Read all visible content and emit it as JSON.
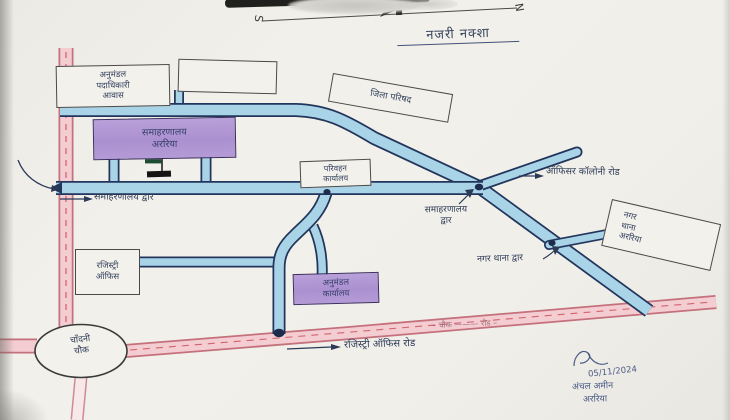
{
  "page": {
    "title": "नजरी नक्शा"
  },
  "compass": {
    "south": "S",
    "north": "N"
  },
  "places": {
    "sdo_residence": "अनुमंडल\nपदाधिकारी\nआवास",
    "zila_parishad": "जिला परिषद",
    "collectorate": "समाहरणालय\nअररिया",
    "transport_office": "परिवहन\nकार्यालय",
    "registry_office": "रजिस्ट्री\nऑफिस",
    "subdivision_office": "अनुमंडल\nकार्यालय",
    "nagar_thana": "नगर\nथाना\nअररिया",
    "chandni_chowk": "चाँदनी\nचौक"
  },
  "labels": {
    "collectorate_gate_west": "समाहरणालय द्वार",
    "collectorate_gate_south": "समाहरणालय\nद्वार",
    "officer_colony_road": "ऑफिसर कॉलोनी रोड",
    "nagar_thana_gate": "नगर थाना द्वार",
    "registry_office_road": "रजिस्ट्री ऑफिस रोड",
    "road_inscription": "– चौक ——— रोड –"
  },
  "signature": {
    "date": "05/11/2024",
    "name": "अंचल अमीन",
    "place": "अररिया"
  },
  "colors": {
    "road_blue_fill": "#a9d3e6",
    "road_blue_edge": "#22355c",
    "road_pink_fill": "#f3cdd2",
    "road_pink_edge": "#c4717c",
    "dash_red": "#c94a52",
    "highlight_purple": "#b096d4",
    "ink": "#2e3b58"
  }
}
